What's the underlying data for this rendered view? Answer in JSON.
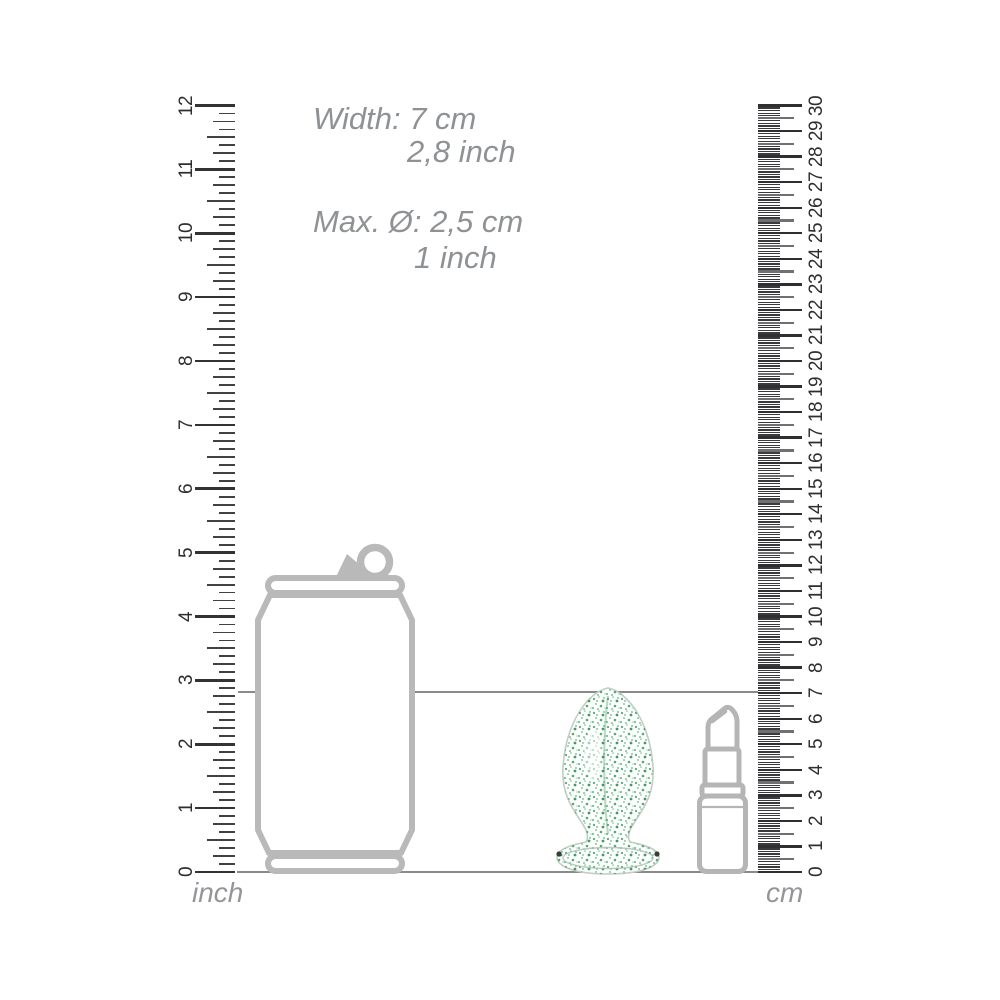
{
  "dimensions_text": {
    "width_cm": "Width: 7 cm",
    "width_inch": "2,8 inch",
    "diameter_cm": "Max. Ø: 2,5 cm",
    "diameter_inch": "1 inch"
  },
  "rulers": {
    "inch": {
      "label": "inch",
      "min": 0,
      "max": 12,
      "subdivisions_per_unit": 8,
      "numbers": [
        0,
        1,
        2,
        3,
        4,
        5,
        6,
        7,
        8,
        9,
        10,
        11,
        12
      ]
    },
    "cm": {
      "label": "cm",
      "min": 0,
      "max": 30,
      "subdivisions_per_unit": 10,
      "numbers": [
        0,
        1,
        2,
        3,
        4,
        5,
        6,
        7,
        8,
        9,
        10,
        11,
        12,
        13,
        14,
        15,
        16,
        17,
        18,
        19,
        20,
        21,
        22,
        23,
        24,
        25,
        26,
        27,
        28,
        29,
        30
      ]
    }
  },
  "objects": {
    "can": "drink-can-outline",
    "product": "glass-plug-with-green-glitter",
    "lipstick": "lipstick-outline"
  },
  "guide_values": {
    "height_line_cm": 7,
    "height_line_inch": 2.8,
    "baseline": 0
  },
  "colors": {
    "dimension_text": "#8f9294",
    "outline_gray": "#b9b9b9",
    "ruler_dark": "#333335",
    "ruler_half_cm": "#707072",
    "guide_line": "#8a8a8a",
    "glitter_green": "#4fae6d"
  }
}
